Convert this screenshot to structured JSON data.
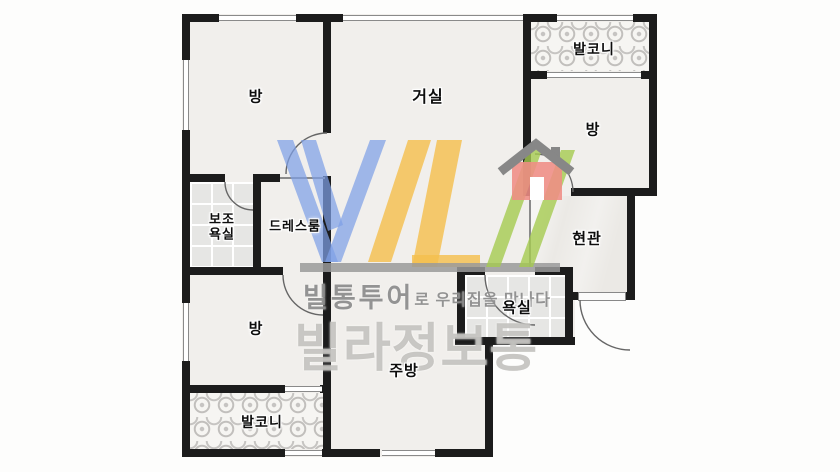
{
  "page": {
    "type": "apartment-floor-plan"
  },
  "rooms": [
    {
      "id": "bedroom-top-left",
      "label": "방"
    },
    {
      "id": "living-room",
      "label": "거실"
    },
    {
      "id": "balcony-top",
      "label": "발코니"
    },
    {
      "id": "bedroom-right",
      "label": "방"
    },
    {
      "id": "aux-bathroom",
      "label": "보조 욕실",
      "label_line1": "보조",
      "label_line2": "욕실"
    },
    {
      "id": "dressroom",
      "label": "드레스룸"
    },
    {
      "id": "entrance",
      "label": "현관"
    },
    {
      "id": "bathroom",
      "label": "욕실"
    },
    {
      "id": "bedroom-bottom-left",
      "label": "방"
    },
    {
      "id": "kitchen",
      "label": "주방"
    },
    {
      "id": "balcony-bottom",
      "label": "발코니"
    }
  ],
  "watermark": {
    "tagline_bold": "빌통투어",
    "tagline_rest": "로 우리집을 만나다",
    "brand": "빌라정보통"
  },
  "colors": {
    "wall": "#1c1c1c",
    "floor": "#f1efec",
    "logo_blue": "#8aa6e6",
    "logo_yellow": "#f5c35c",
    "logo_green": "#aecf62",
    "logo_red": "#f0928b",
    "logo_roof_gray": "#878787",
    "logo_bar_gray": "#9a9a9a",
    "tagline_gray": "#8a8a8a",
    "brand_gray": "#b9b7b4"
  }
}
